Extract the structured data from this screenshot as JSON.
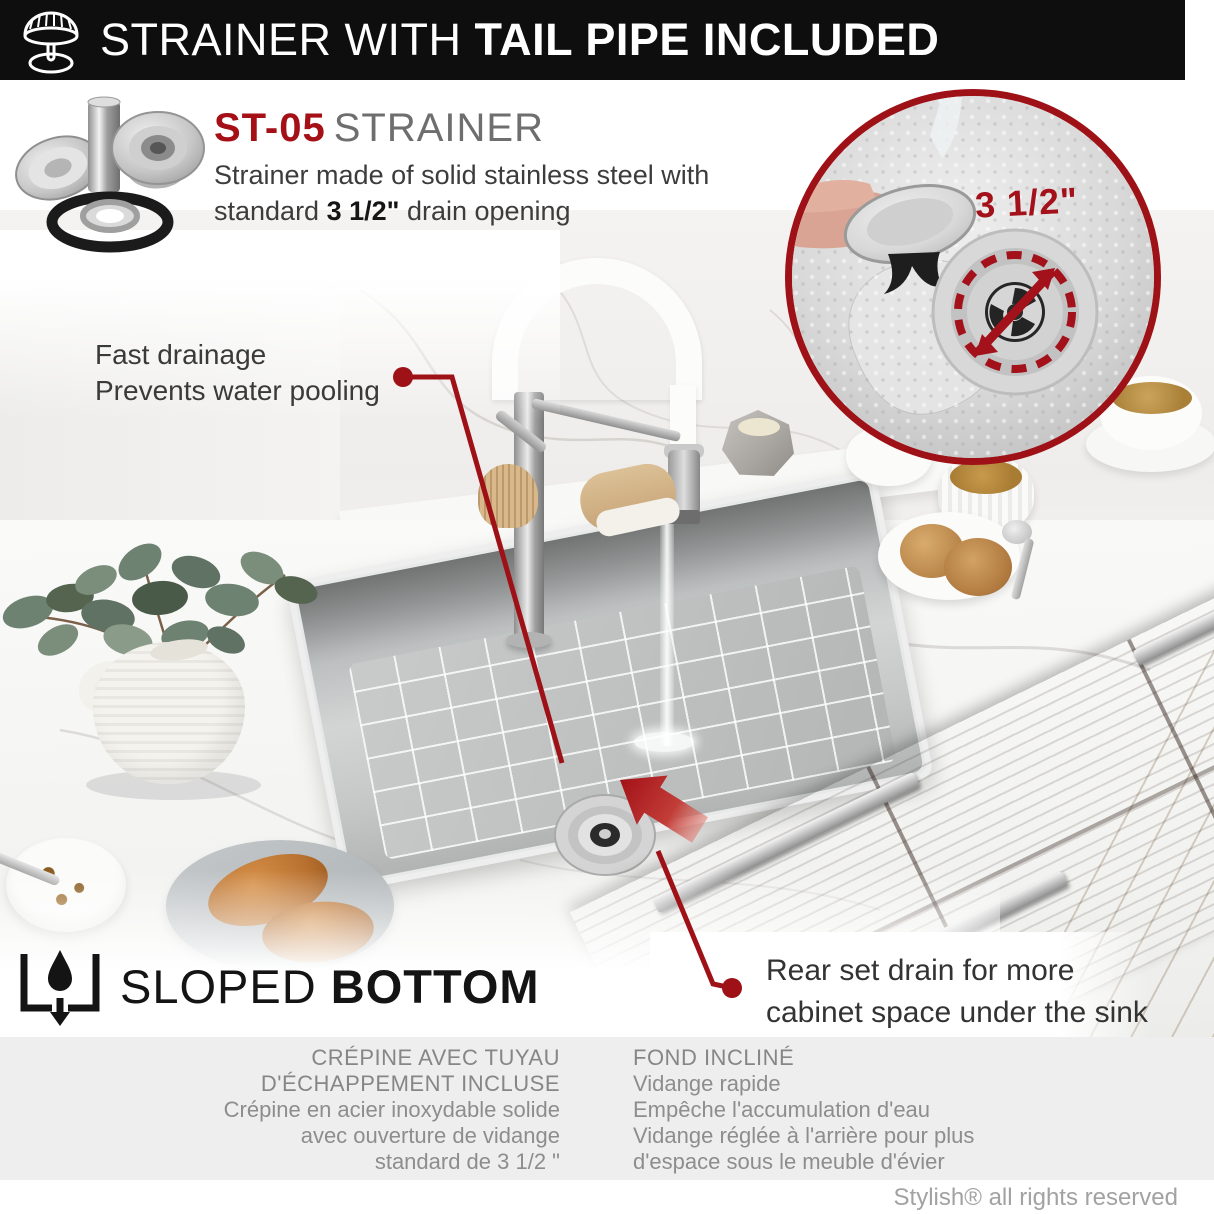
{
  "header": {
    "title_regular": "STRAINER WITH ",
    "title_bold": "TAIL PIPE INCLUDED"
  },
  "product": {
    "code": "ST-05",
    "name": "STRAINER",
    "desc_line1": "Strainer made of solid stainless steel with",
    "desc_line2_pre": "standard ",
    "desc_size": "3 1/2\"",
    "desc_line2_post": " drain opening"
  },
  "inset": {
    "size_label": "3 1/2\""
  },
  "callouts": {
    "fast_line1": "Fast drainage",
    "fast_line2": "Prevents water pooling",
    "rear_line1": "Rear set drain for more",
    "rear_line2": "cabinet space under the sink"
  },
  "sloped": {
    "label_regular": "SLOPED ",
    "label_bold": "BOTTOM"
  },
  "french": {
    "left": {
      "h1": "CRÉPINE AVEC TUYAU",
      "h2": "D'ÉCHAPPEMENT INCLUSE",
      "b1": "Crépine en acier inoxydable solide",
      "b2": "avec ouverture de vidange",
      "b3": "standard de 3 1/2 \""
    },
    "right": {
      "h1": "FOND INCLINÉ",
      "b1": "Vidange rapide",
      "b2": "Empêche l'accumulation d'eau",
      "b3": "Vidange réglée à l'arrière pour plus",
      "b4": "d'espace sous le meuble d'évier"
    }
  },
  "footer": {
    "text": "Stylish® all rights reserved"
  },
  "colors": {
    "accent_red": "#9e1117",
    "header_bg": "#0e0e0e",
    "gray_band": "#efeeee",
    "text_gray": "#8d8d8d"
  }
}
